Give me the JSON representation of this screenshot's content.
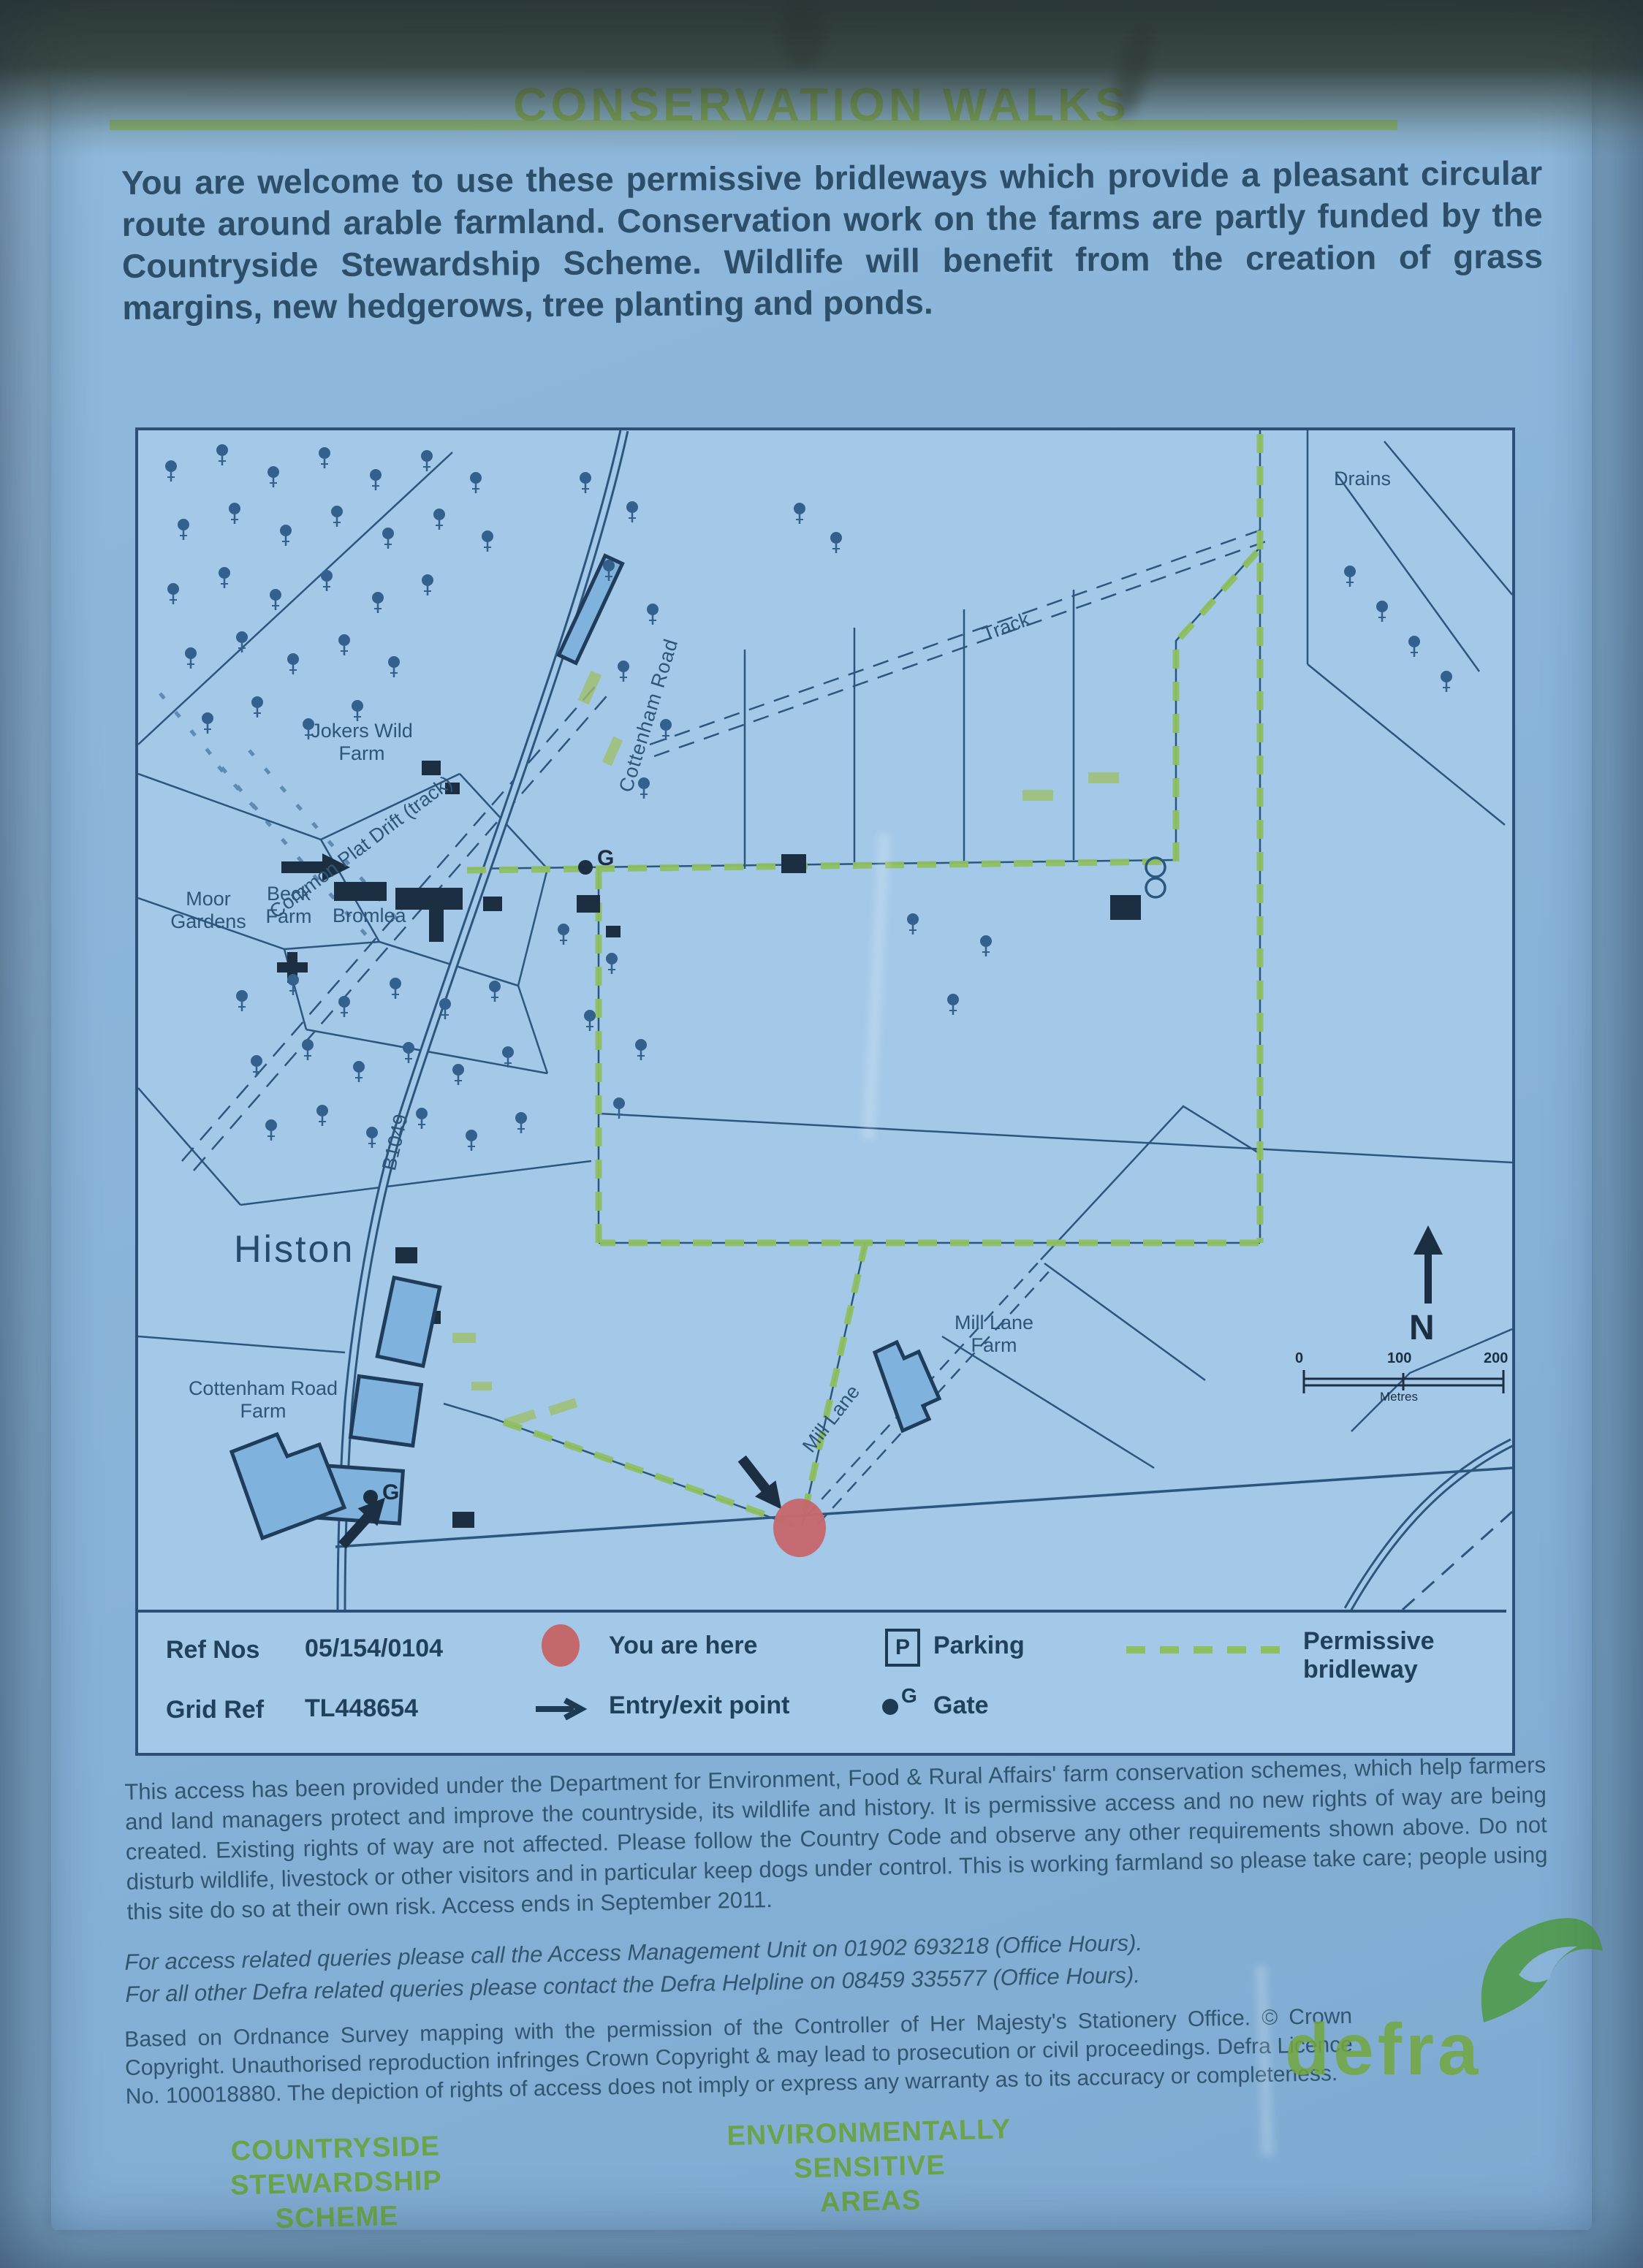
{
  "sign": {
    "title": "CONSERVATION WALKS",
    "intro": "You are welcome to use these permissive bridleways which provide a pleasant circular route around arable farmland. Conservation work on the farms are partly funded by the Countryside Stewardship Scheme.  Wildlife will benefit from the creation of grass margins, new hedgerows, tree planting and ponds."
  },
  "map": {
    "labels": [
      {
        "text": "Drains"
      },
      {
        "text": "Cottenham Road"
      },
      {
        "text": "Track"
      },
      {
        "text": "Common Plat Drift (track)"
      },
      {
        "text": "Jokers Wild\nFarm"
      },
      {
        "text": "Moor\nGardens"
      },
      {
        "text": "Beck\nFarm"
      },
      {
        "text": "Bromlea"
      },
      {
        "text": "B1049"
      },
      {
        "text": "Histon"
      },
      {
        "text": "Cottenham Road\nFarm"
      },
      {
        "text": "Mill Lane\nFarm"
      },
      {
        "text": "Mill Lane"
      },
      {
        "text": "N"
      }
    ],
    "gate_letter": "G",
    "scale": {
      "start": "0",
      "mid": "100",
      "end": "200",
      "unit": "Metres"
    }
  },
  "legend": {
    "ref_nos_label": "Ref Nos",
    "ref_nos_value": "05/154/0104",
    "grid_ref_label": "Grid Ref",
    "grid_ref_value": "TL448654",
    "you_are_here": "You are here",
    "entry_exit": "Entry/exit point",
    "parking": "Parking",
    "parking_symbol": "P",
    "gate": "Gate",
    "permissive_bridleway": "Permissive bridleway"
  },
  "footer": {
    "para1": "This access has been provided under the Department for Environment, Food & Rural Affairs' farm conservation schemes, which help farmers and land managers protect and improve the countryside, its wildlife and history. It is permissive access and no new rights of way are being created. Existing rights of way are not affected. Please follow the Country Code and observe any other requirements shown above. Do not disturb wildlife, livestock or other visitors and in particular keep dogs under control. This is working farmland so please take care; people using this site do so at their own risk. Access ends in September 2011.",
    "para2_line1": "For access related queries please call the Access Management Unit on 01902 693218 (Office Hours).",
    "para2_line2": "For all other Defra related queries please contact the Defra Helpline on 08459 335577 (Office Hours).",
    "para3": "Based on Ordnance Survey mapping with the permission of the Controller of Her Majesty's Stationery Office. © Crown Copyright. Unauthorised reproduction infringes Crown Copyright & may lead to prosecution or civil proceedings. Defra Licence No. 100018880. The depiction of rights of access does not imply or express any warranty as to its accuracy or completeness.",
    "logo_css": "COUNTRYSIDE\nSTEWARDSHIP\nSCHEME",
    "logo_esa": "ENVIRONMENTALLY\nSENSITIVE\nAREAS",
    "defra": "defra"
  },
  "colors": {
    "panel": "#8cb6da",
    "frame": "#7ba3c6",
    "map_background": "#a3c8e8",
    "map_line": "#2d567e",
    "title_green": "#7cab3a",
    "bridleway_green": "#8fc060",
    "you_are_here_red": "#c5686c",
    "body_text": "#2c4e68",
    "logo_green": "#68a33c"
  }
}
